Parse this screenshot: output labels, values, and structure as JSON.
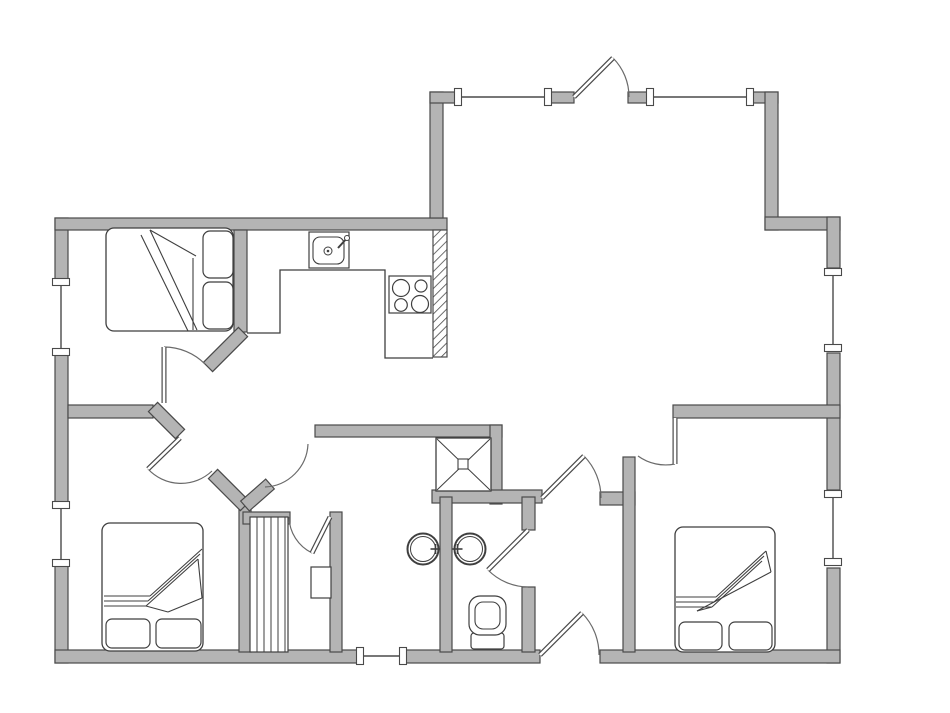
{
  "meta": {
    "canvas": {
      "w": 950,
      "h": 713,
      "bg": "#ffffff"
    }
  },
  "style": {
    "wall_fill": "#b4b4b4",
    "wall_stroke": "#4a4a4a",
    "thin_line": "#4a4a4a",
    "arc_line": "#6a6a6a",
    "fixture_line": "#3f3f3f",
    "white": "#ffffff"
  },
  "walls": [
    {
      "x": 55,
      "y": 218,
      "w": 13,
      "h": 64
    },
    {
      "x": 55,
      "y": 352,
      "w": 13,
      "h": 153
    },
    {
      "x": 55,
      "y": 563,
      "w": 13,
      "h": 100
    },
    {
      "x": 55,
      "y": 218,
      "w": 392,
      "h": 12
    },
    {
      "x": 430,
      "y": 92,
      "w": 13,
      "h": 126
    },
    {
      "x": 430,
      "y": 92,
      "w": 28,
      "h": 11
    },
    {
      "x": 548,
      "y": 92,
      "w": 26,
      "h": 11
    },
    {
      "x": 628,
      "y": 92,
      "w": 22,
      "h": 11
    },
    {
      "x": 750,
      "y": 92,
      "w": 28,
      "h": 11
    },
    {
      "x": 765,
      "y": 92,
      "w": 13,
      "h": 138
    },
    {
      "x": 765,
      "y": 217,
      "w": 75,
      "h": 13
    },
    {
      "x": 827,
      "y": 217,
      "w": 13,
      "h": 51
    },
    {
      "x": 827,
      "y": 353,
      "w": 13,
      "h": 137
    },
    {
      "x": 827,
      "y": 568,
      "w": 13,
      "h": 95
    },
    {
      "x": 55,
      "y": 650,
      "w": 305,
      "h": 13
    },
    {
      "x": 403,
      "y": 650,
      "w": 137,
      "h": 13
    },
    {
      "x": 600,
      "y": 650,
      "w": 240,
      "h": 13
    },
    {
      "x": 68,
      "y": 405,
      "w": 85,
      "h": 13
    },
    {
      "x": 234,
      "y": 230,
      "w": 13,
      "h": 102
    },
    {
      "x": 315,
      "y": 425,
      "w": 187,
      "h": 12
    },
    {
      "x": 490,
      "y": 425,
      "w": 12,
      "h": 79
    },
    {
      "x": 432,
      "y": 490,
      "w": 110,
      "h": 13
    },
    {
      "x": 440,
      "y": 497,
      "w": 12,
      "h": 155
    },
    {
      "x": 522,
      "y": 497,
      "w": 13,
      "h": 33
    },
    {
      "x": 522,
      "y": 587,
      "w": 13,
      "h": 65
    },
    {
      "x": 600,
      "y": 492,
      "w": 35,
      "h": 13
    },
    {
      "x": 623,
      "y": 457,
      "w": 12,
      "h": 195
    },
    {
      "x": 673,
      "y": 405,
      "w": 167,
      "h": 13
    },
    {
      "x": 239,
      "y": 505,
      "w": 12,
      "h": 147
    },
    {
      "x": 243,
      "y": 512,
      "w": 47,
      "h": 12
    },
    {
      "x": 330,
      "y": 512,
      "w": 12,
      "h": 140
    }
  ],
  "diag_walls": [
    {
      "x1": 243,
      "y1": 332,
      "x2": 208,
      "y2": 367,
      "w": 13
    },
    {
      "x1": 153,
      "y1": 407,
      "x2": 180,
      "y2": 434,
      "w": 13
    },
    {
      "x1": 213,
      "y1": 474,
      "x2": 245,
      "y2": 506,
      "w": 13
    },
    {
      "x1": 245,
      "y1": 506,
      "x2": 270,
      "y2": 484,
      "w": 13
    }
  ],
  "hatch_walls": [
    {
      "x": 433,
      "y": 230,
      "w": 14,
      "h": 127
    }
  ],
  "windows": [
    {
      "x1": 61,
      "y1": 282,
      "x2": 61,
      "y2": 352
    },
    {
      "x1": 61,
      "y1": 505,
      "x2": 61,
      "y2": 563
    },
    {
      "x1": 458,
      "y1": 97,
      "x2": 548,
      "y2": 97
    },
    {
      "x1": 650,
      "y1": 97,
      "x2": 750,
      "y2": 97
    },
    {
      "x1": 833,
      "y1": 272,
      "x2": 833,
      "y2": 348
    },
    {
      "x1": 833,
      "y1": 494,
      "x2": 833,
      "y2": 562
    },
    {
      "x1": 360,
      "y1": 656,
      "x2": 403,
      "y2": 656
    }
  ],
  "doors": [
    {
      "name": "door-living-north",
      "leaf": [
        574,
        97,
        613,
        58
      ],
      "arc": "M 613 58 A 55 55 0 0 1 629 97"
    },
    {
      "name": "door-bedroom-top-left",
      "leaf": [
        164,
        403,
        164,
        347
      ],
      "arc": "M 164 347 A 58 58 0 0 1 205 364"
    },
    {
      "name": "door-bedroom-bottom-left",
      "leaf": [
        180,
        438,
        148,
        469
      ],
      "arc": "M 148 469 A 45 45 0 0 0 212 471"
    },
    {
      "name": "door-washroom",
      "leaf": null,
      "arc": "M 265 487 A 45 45 0 0 0 308 444"
    },
    {
      "name": "door-sauna",
      "leaf": [
        330,
        517,
        312,
        553
      ],
      "arc": "M 312 553 A 41 41 0 0 1 289 517"
    },
    {
      "name": "door-toilet",
      "leaf": [
        528,
        530,
        488,
        570
      ],
      "arc": "M 488 570 A 57 57 0 0 0 528 587"
    },
    {
      "name": "door-hall-living",
      "leaf": [
        542,
        498,
        584,
        456
      ],
      "arc": "M 584 456 A 60 60 0 0 1 601 498"
    },
    {
      "name": "door-entrance-south",
      "leaf": [
        540,
        655,
        582,
        613
      ],
      "arc": "M 582 613 A 59 59 0 0 1 599 655"
    },
    {
      "name": "door-bedroom-right",
      "leaf": [
        675,
        418,
        675,
        464
      ],
      "arc": "M 675 464 A 47 47 0 0 1 638 456"
    }
  ],
  "kitchen": {
    "counter_path": "M 247 333 L 280 333 L 280 270 L 385 270 L 385 358 L 433 358",
    "sink": {
      "outer": {
        "x": 309,
        "y": 232,
        "w": 40,
        "h": 36
      },
      "inner": {
        "x": 313,
        "y": 237,
        "w": 31,
        "h": 27,
        "rx": 7
      },
      "drain": {
        "cx": 328,
        "cy": 251,
        "r": 4
      },
      "faucet_line": [
        338,
        248,
        348,
        237
      ],
      "faucet_knob": {
        "cx": 347,
        "cy": 238,
        "r": 2.5
      }
    },
    "stove": {
      "box": {
        "x": 389,
        "y": 276,
        "w": 42,
        "h": 37
      },
      "burners": [
        {
          "cx": 401,
          "cy": 288,
          "r": 8.5
        },
        {
          "cx": 421,
          "cy": 286,
          "r": 6.0
        },
        {
          "cx": 401,
          "cy": 305,
          "r": 6.3
        },
        {
          "cx": 420,
          "cy": 304,
          "r": 8.5
        }
      ]
    }
  },
  "chimney": {
    "box": {
      "x": 436,
      "y": 438,
      "w": 55,
      "h": 53
    },
    "center_square": {
      "x": 458,
      "y": 459,
      "w": 10,
      "h": 10
    }
  },
  "sauna": {
    "bench_box": {
      "x": 250,
      "y": 517,
      "w": 38,
      "h": 135
    },
    "plank_xs": [
      257,
      264,
      271,
      278,
      285
    ],
    "heater": {
      "x": 311,
      "y": 567,
      "w": 20,
      "h": 31
    }
  },
  "toilet": {
    "bowl_outer": {
      "x": 469,
      "y": 596,
      "w": 37,
      "h": 39,
      "rx": 11
    },
    "bowl_inner": {
      "x": 475,
      "y": 602,
      "w": 25,
      "h": 27,
      "rx": 8
    },
    "tank": {
      "x": 471,
      "y": 633,
      "w": 33,
      "h": 16,
      "rx": 3
    }
  },
  "basins": [
    {
      "name": "washbasin-left",
      "cx": 423,
      "cy": 549,
      "r": 15.5,
      "tap_side": "right"
    },
    {
      "name": "washbasin-right",
      "cx": 470,
      "cy": 549,
      "r": 15.5,
      "tap_side": "left"
    }
  ],
  "beds": [
    {
      "name": "bed-top-left",
      "rect": {
        "x": 106,
        "y": 228,
        "w": 127,
        "h": 103,
        "rx": 8
      },
      "pillows": [
        {
          "x": 203,
          "y": 231,
          "w": 30,
          "h": 47,
          "rx": 7
        },
        {
          "x": 203,
          "y": 282,
          "w": 30,
          "h": 47,
          "rx": 7
        }
      ],
      "lines": [
        [
          150,
          230,
          197,
          330
        ],
        [
          141,
          235,
          188,
          331
        ],
        [
          150,
          230,
          196,
          256
        ],
        [
          193,
          258,
          193,
          330
        ]
      ]
    },
    {
      "name": "bed-bottom-left",
      "rect": {
        "x": 102,
        "y": 523,
        "w": 101,
        "h": 128,
        "rx": 8
      },
      "pillows": [
        {
          "x": 106,
          "y": 619,
          "w": 44,
          "h": 29,
          "rx": 6
        },
        {
          "x": 156,
          "y": 619,
          "w": 45,
          "h": 29,
          "rx": 6
        }
      ],
      "lines": [
        [
          104,
          596,
          150,
          596
        ],
        [
          104,
          601,
          148,
          601
        ],
        [
          104,
          606,
          146,
          606
        ],
        [
          150,
          596,
          202,
          549
        ],
        [
          148,
          601,
          200,
          554
        ],
        [
          146,
          606,
          198,
          559
        ],
        [
          198,
          559,
          202,
          598
        ],
        [
          202,
          598,
          168,
          612
        ],
        [
          168,
          612,
          146,
          606
        ]
      ]
    },
    {
      "name": "bed-right",
      "rect": {
        "x": 675,
        "y": 527,
        "w": 100,
        "h": 125,
        "rx": 8
      },
      "pillows": [
        {
          "x": 679,
          "y": 622,
          "w": 43,
          "h": 28,
          "rx": 6
        },
        {
          "x": 729,
          "y": 622,
          "w": 43,
          "h": 28,
          "rx": 6
        }
      ],
      "lines": [
        [
          676,
          597,
          716,
          597
        ],
        [
          676,
          602,
          714,
          602
        ],
        [
          676,
          607,
          712,
          607
        ],
        [
          716,
          597,
          766,
          551
        ],
        [
          714,
          602,
          764,
          556
        ],
        [
          712,
          607,
          762,
          561
        ],
        [
          766,
          551,
          771,
          572
        ],
        [
          771,
          572,
          697,
          611
        ],
        [
          697,
          611,
          712,
          607
        ]
      ]
    }
  ]
}
